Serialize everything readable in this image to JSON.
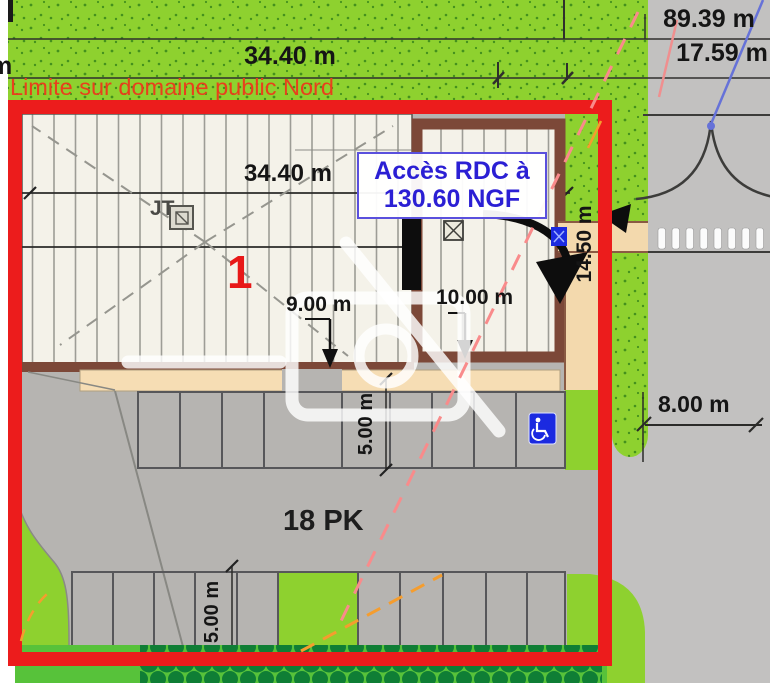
{
  "labels": {
    "clipped_left_text": "m",
    "dim_top_width": "34.40 m",
    "dim_total_depth": "89.39 m",
    "dim_road_width": "17.59 m",
    "limit_note": "Limite sur domaine public Nord",
    "dim_building_width": "34.40 m",
    "access_note_line1": "Accès RDC à",
    "access_note_line2": "130.60 NGF",
    "roof_marker": "JT",
    "lot_number": "1",
    "dim_left_building": "9.00 m",
    "dim_annex_width": "10.00 m",
    "dim_right_depth": "14.50 m",
    "dim_road_east": "8.00 m",
    "dim_parking_depth_mid": "5.00 m",
    "dim_parking_depth_bottom": "5.00 m",
    "parking_total": "18 PK"
  },
  "icons": {
    "handicap_parking": "accessible-parking-icon",
    "roof_window": "roof-window-icon",
    "jt_access": "jt-roof-access-icon",
    "entrance_door": "entrance-door",
    "entrance_arrow": "entrance-swing-arrow-icon",
    "boundary_arrow": "boundary-arrow-icon",
    "watermark": "no-photo-watermark-icon",
    "tree_canopy": "tree-canopy-icon",
    "crosswalk": "crosswalk"
  },
  "colors": {
    "boundary_red": "#ec1c1c",
    "limit_text": "#e8401c",
    "access_text": "#2b1fd4",
    "lot_text": "#e81818",
    "grass": "#8ed12f",
    "hedge_dark": "#0f7e35",
    "road_gray": "#c2c1c0",
    "parking_gray": "#b6b4b1",
    "building_fill": "#f4f2e9",
    "terrace_beige": "#f6ddb4",
    "wall_brown": "#7c4838",
    "handicap_blue": "#1b2ae0"
  }
}
